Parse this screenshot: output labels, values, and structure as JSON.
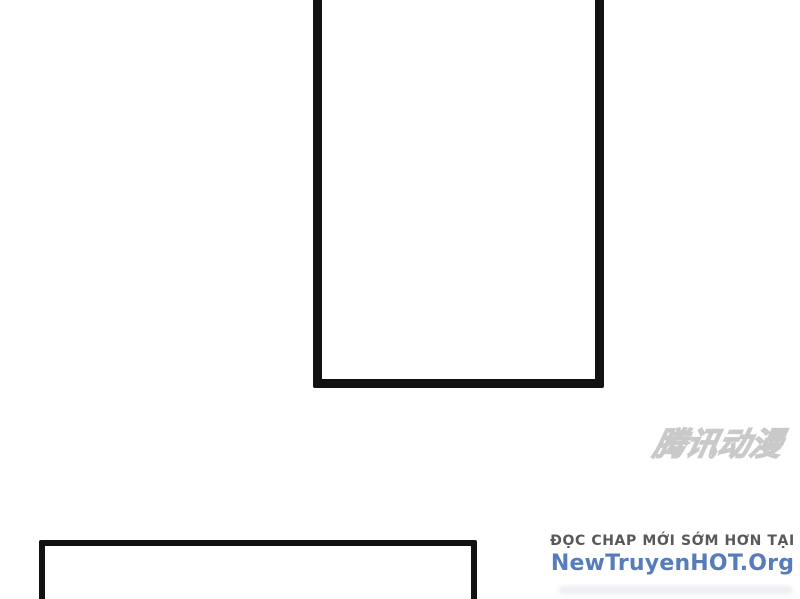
{
  "page": {
    "background_color": "#ffffff",
    "description_colors": {
      "panel_border": "#121212"
    }
  },
  "panels": {
    "top": {
      "content": ""
    },
    "bottom": {
      "content": ""
    }
  },
  "watermark": {
    "text": "腾讯动漫",
    "color": "#c9c9c9"
  },
  "footer": {
    "tagline": "ĐỌC CHAP MỚI SỚM HƠN TẠI",
    "tagline_color": "#58595b",
    "site": "NewTruyenHOT.Org",
    "site_color": "#567cbc"
  }
}
